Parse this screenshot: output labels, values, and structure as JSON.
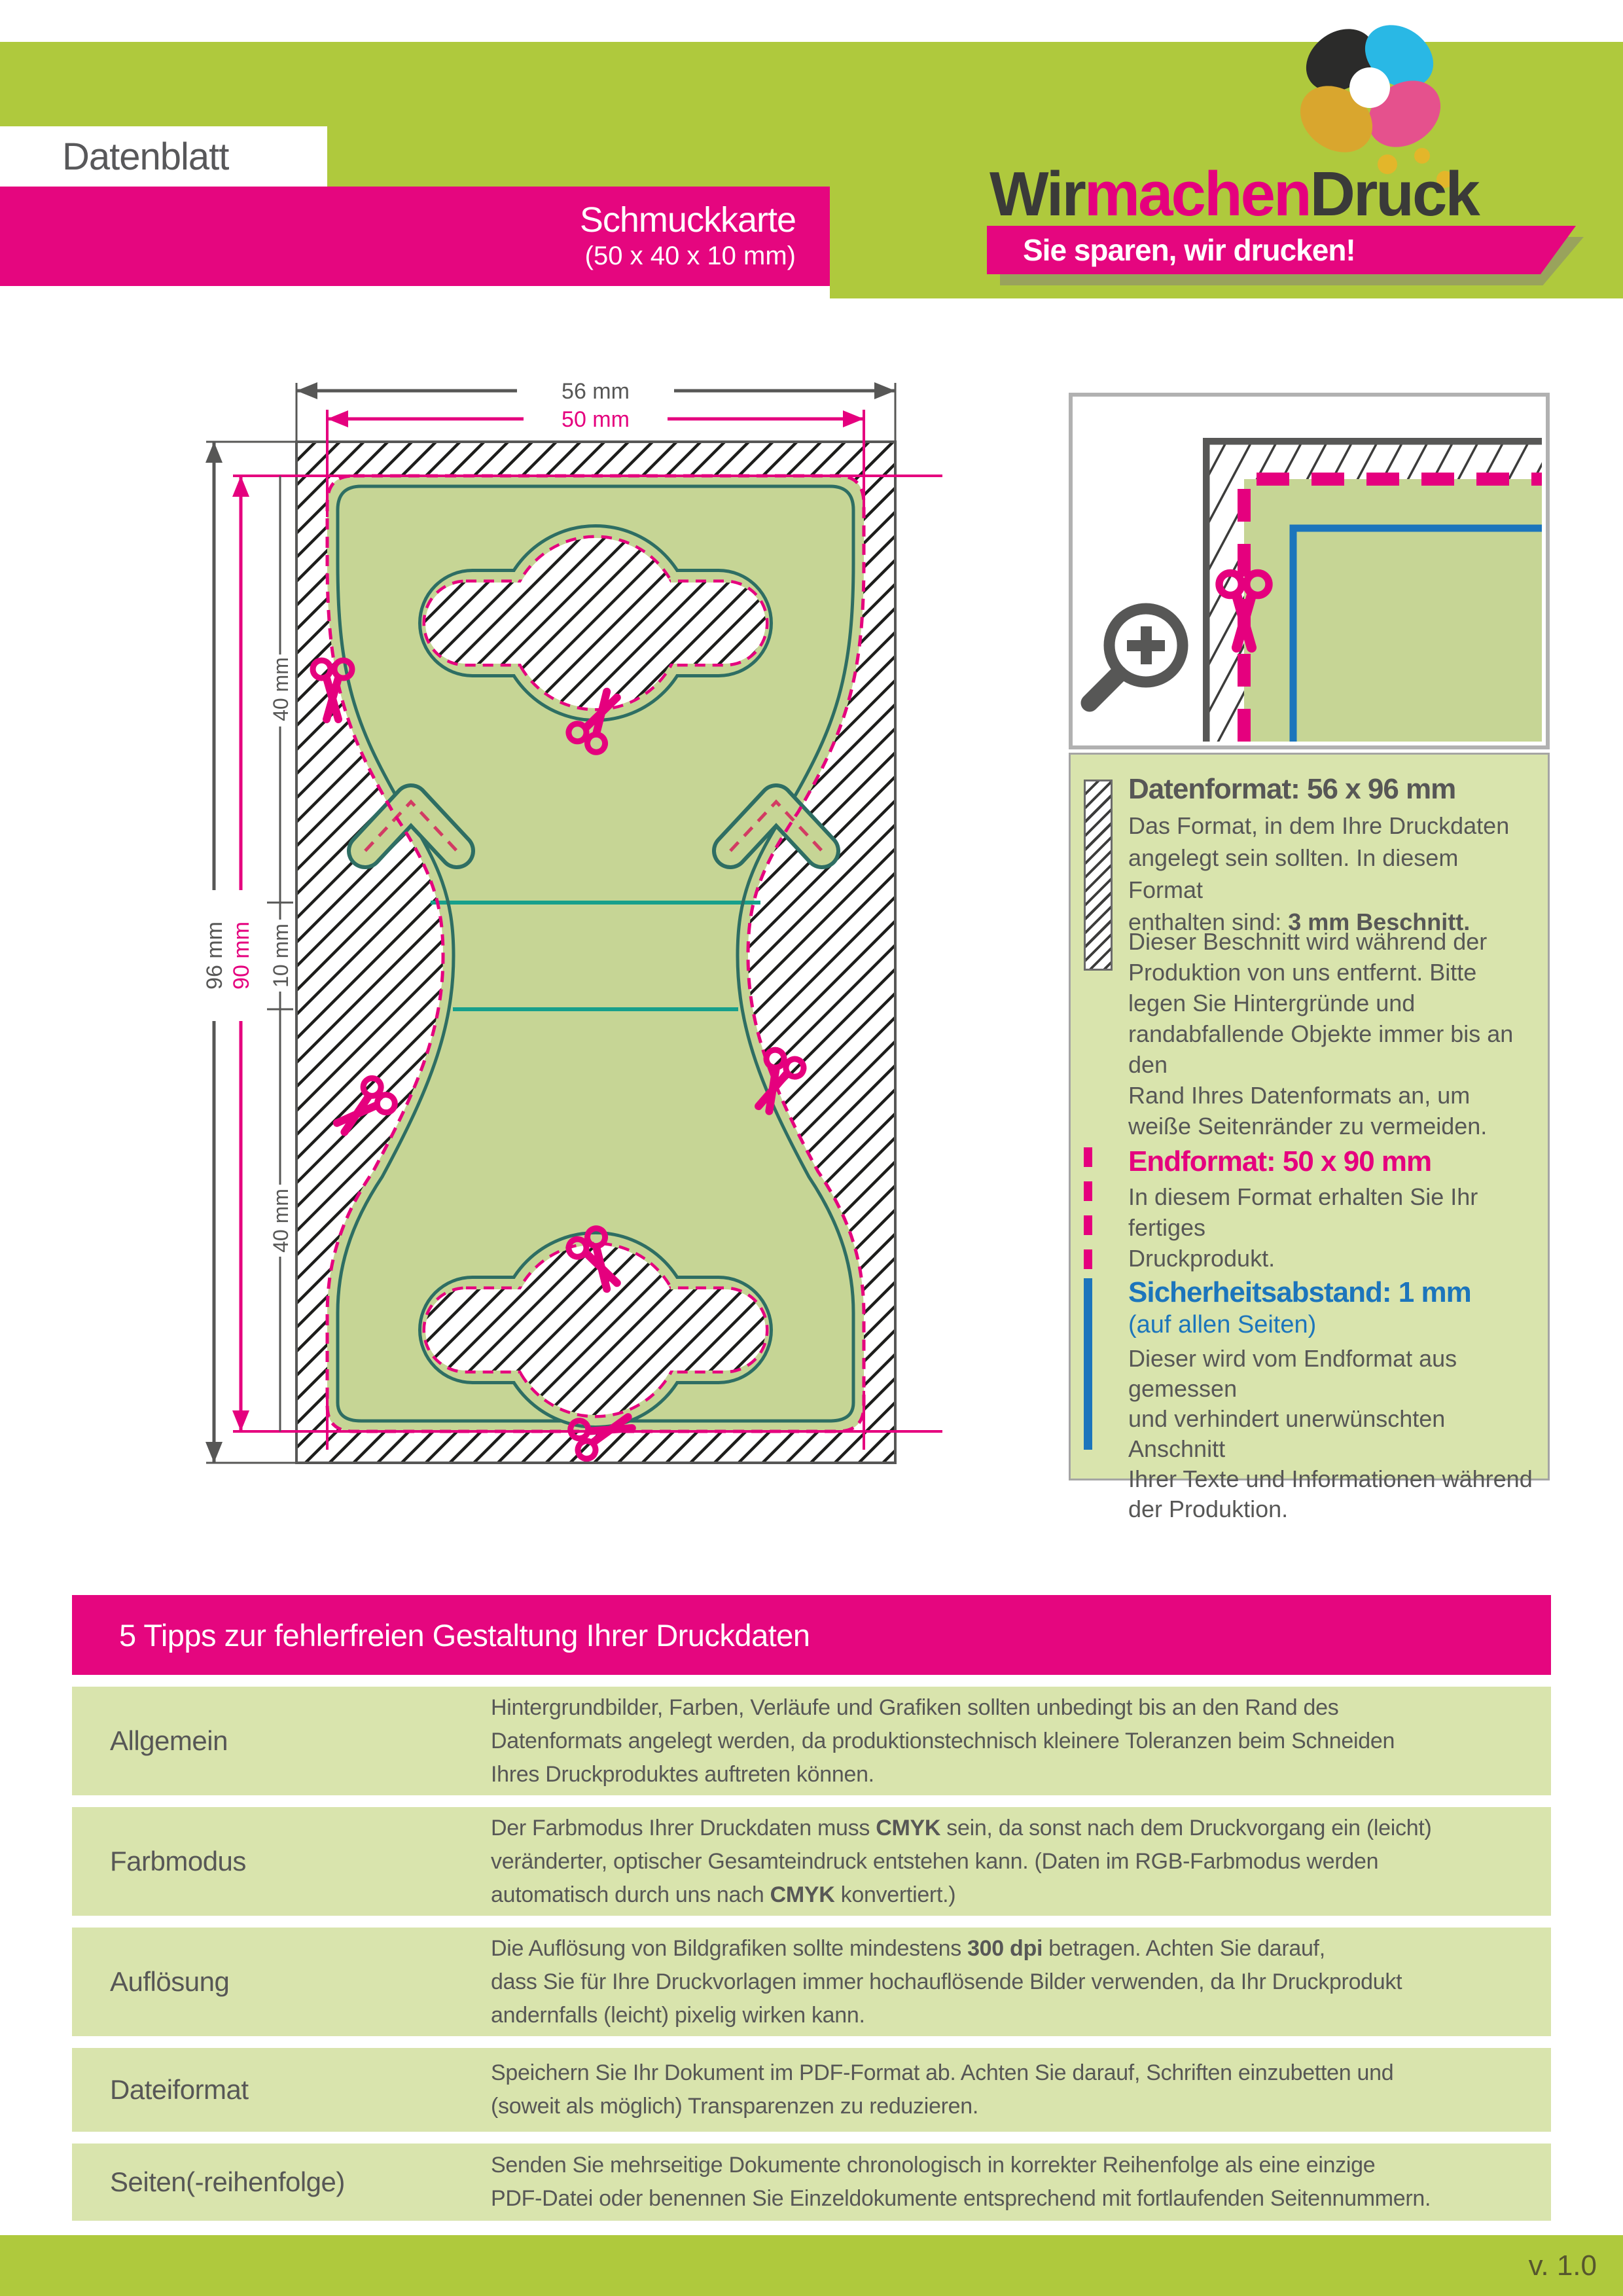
{
  "colors": {
    "brand_green": "#afc93d",
    "accent_pink": "#e5007e",
    "card_green": "#c6d595",
    "panel_green": "#d9e4ad",
    "teal": "#2e6e63",
    "fold_teal": "#17a08b",
    "blue": "#1c75bc",
    "gray": "#575756"
  },
  "header": {
    "doc_label": "Datenblatt",
    "product_title": "Schmuckkarte",
    "product_size": "(50 x 40 x 10 mm)",
    "logo": {
      "wir": "Wir",
      "machen": "machen",
      "druck": "Druck",
      "slogan": "Sie sparen, wir drucken!"
    }
  },
  "diagram": {
    "dims": {
      "width_outer": "56 mm",
      "width_inner": "50 mm",
      "height_outer": "96 mm",
      "height_inner": "90 mm",
      "seg_top": "40 mm",
      "seg_mid": "10 mm",
      "seg_bottom": "40 mm"
    }
  },
  "info_panel": {
    "datenformat": {
      "heading": "Datenformat: 56 x 96 mm",
      "body1": [
        {
          "t": "Das Format, in dem Ihre Druckdaten\nangelegt sein sollten. In diesem Format\nenthalten sind: "
        },
        {
          "t": "3 mm Beschnitt.",
          "b": 1
        }
      ],
      "body2": "Dieser Beschnitt wird während der\nProduktion von uns entfernt. Bitte\nlegen Sie Hintergründe und\nrandabfallende Objekte immer bis an den\nRand Ihres Datenformats an, um\nweiße Seitenränder zu vermeiden."
    },
    "endformat": {
      "heading": "Endformat: 50 x 90 mm",
      "body": "In diesem Format erhalten Sie Ihr fertiges\nDruckprodukt."
    },
    "sicherheitsabstand": {
      "heading": "Sicherheitsabstand: 1 mm",
      "subheading": "(auf allen Seiten)",
      "body": "Dieser wird vom Endformat aus gemessen\nund verhindert unerwünschten Anschnitt\nIhrer Texte und Informationen während\nder Produktion."
    }
  },
  "tips": {
    "banner": "5 Tipps zur fehlerfreien Gestaltung Ihrer Druckdaten",
    "rows": [
      {
        "label": "Allgemein",
        "text": [
          {
            "t": "Hintergrundbilder, Farben, Verläufe und Grafiken sollten unbedingt bis an den Rand des\nDatenformats angelegt werden, da produktionstechnisch kleinere Toleranzen beim Schneiden\nIhres Druckproduktes auftreten können."
          }
        ]
      },
      {
        "label": "Farbmodus",
        "text": [
          {
            "t": "Der Farbmodus Ihrer Druckdaten muss "
          },
          {
            "t": "CMYK",
            "b": 1
          },
          {
            "t": " sein, da sonst nach dem Druckvorgang ein (leicht)\nveränderter, optischer Gesamteindruck entstehen kann. (Daten im RGB-Farbmodus werden\nautomatisch durch uns nach "
          },
          {
            "t": "CMYK",
            "b": 1
          },
          {
            "t": " konvertiert.)"
          }
        ]
      },
      {
        "label": "Auflösung",
        "text": [
          {
            "t": "Die Auflösung von Bildgrafiken sollte mindestens "
          },
          {
            "t": "300 dpi",
            "b": 1
          },
          {
            "t": " betragen. Achten Sie darauf,\ndass Sie für Ihre Druckvorlagen immer hochauflösende Bilder verwenden, da Ihr Druckprodukt\nandernfalls (leicht) pixelig wirken kann."
          }
        ]
      },
      {
        "label": "Dateiformat",
        "text": [
          {
            "t": "Speichern Sie Ihr Dokument im PDF-Format ab. Achten Sie darauf, Schriften einzubetten und\n(soweit als möglich) Transparenzen zu reduzieren."
          }
        ]
      },
      {
        "label": "Seiten(-reihenfolge)",
        "text": [
          {
            "t": "Senden Sie mehrseitige Dokumente chronologisch in korrekter Reihenfolge als eine einzige\nPDF-Datei oder benennen Sie Einzeldokumente entsprechend mit fortlaufenden Seitennummern."
          }
        ]
      }
    ]
  },
  "footer": {
    "version": "v. 1.0"
  }
}
